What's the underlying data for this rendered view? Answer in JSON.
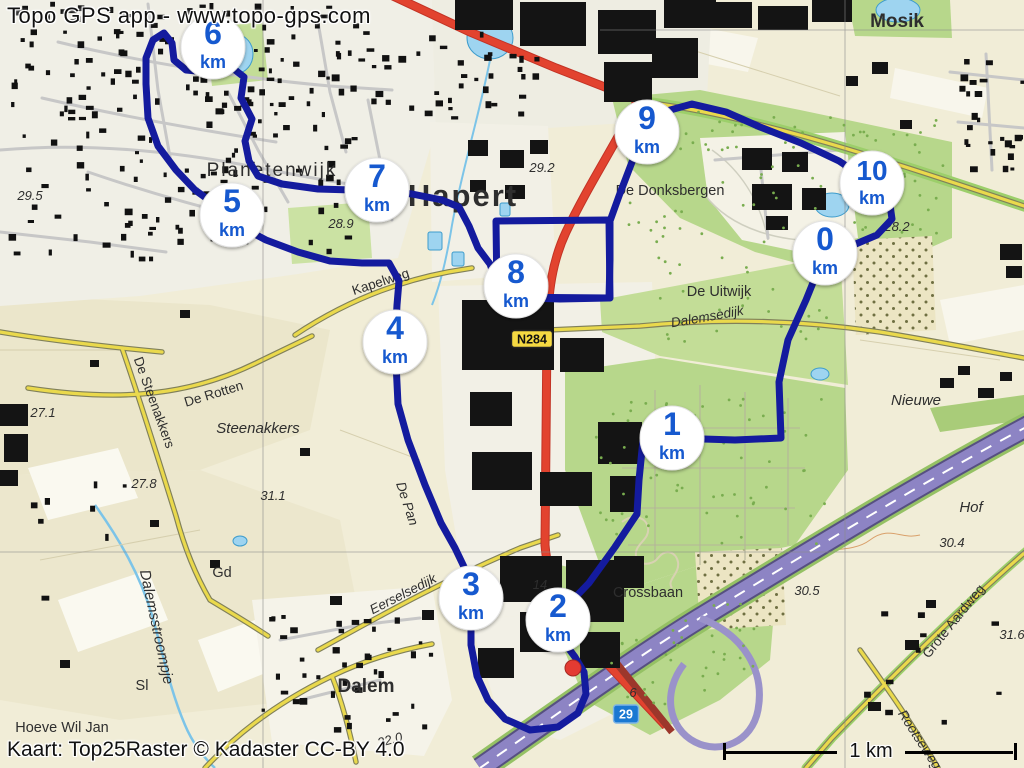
{
  "overlay": {
    "app_credit": "Topo GPS app - www.topo-gps.com",
    "attribution": "Kaart: Top25Raster © Kadaster CC-BY 4.0",
    "scale_label": "1 km"
  },
  "map": {
    "route": {
      "color": "#141b9e",
      "width": 7,
      "points": [
        [
          825,
          253
        ],
        [
          806,
          300
        ],
        [
          788,
          340
        ],
        [
          779,
          382
        ],
        [
          781,
          438
        ],
        [
          735,
          440
        ],
        [
          672,
          438
        ],
        [
          643,
          440
        ],
        [
          639,
          480
        ],
        [
          637,
          514
        ],
        [
          615,
          547
        ],
        [
          589,
          583
        ],
        [
          566,
          607
        ],
        [
          558,
          622
        ],
        [
          563,
          641
        ],
        [
          575,
          657
        ],
        [
          584,
          672
        ],
        [
          586,
          694
        ],
        [
          578,
          713
        ],
        [
          558,
          727
        ],
        [
          530,
          730
        ],
        [
          505,
          719
        ],
        [
          488,
          700
        ],
        [
          477,
          676
        ],
        [
          471,
          645
        ],
        [
          471,
          598
        ],
        [
          466,
          571
        ],
        [
          455,
          548
        ],
        [
          441,
          523
        ],
        [
          425,
          485
        ],
        [
          408,
          440
        ],
        [
          398,
          404
        ],
        [
          395,
          342
        ],
        [
          397,
          305
        ],
        [
          399,
          281
        ],
        [
          389,
          263
        ],
        [
          362,
          263
        ],
        [
          330,
          261
        ],
        [
          298,
          252
        ],
        [
          266,
          240
        ],
        [
          245,
          229
        ],
        [
          232,
          215
        ],
        [
          213,
          203
        ],
        [
          195,
          190
        ],
        [
          176,
          170
        ],
        [
          158,
          146
        ],
        [
          148,
          118
        ],
        [
          146,
          84
        ],
        [
          146,
          58
        ],
        [
          153,
          40
        ],
        [
          164,
          33
        ],
        [
          172,
          43
        ],
        [
          174,
          60
        ],
        [
          186,
          70
        ],
        [
          208,
          72
        ],
        [
          230,
          66
        ],
        [
          244,
          77
        ],
        [
          241,
          98
        ],
        [
          252,
          119
        ],
        [
          245,
          141
        ],
        [
          249,
          161
        ],
        [
          258,
          176
        ],
        [
          282,
          184
        ],
        [
          318,
          189
        ],
        [
          352,
          190
        ],
        [
          377,
          190
        ],
        [
          412,
          194
        ],
        [
          442,
          200
        ],
        [
          459,
          207
        ],
        [
          469,
          226
        ],
        [
          478,
          248
        ],
        [
          490,
          264
        ],
        [
          496,
          281
        ],
        [
          497,
          297
        ],
        [
          560,
          299
        ],
        [
          609,
          298
        ],
        [
          610,
          260
        ],
        [
          610,
          221
        ],
        [
          619,
          196
        ],
        [
          632,
          162
        ],
        [
          647,
          132
        ],
        [
          663,
          112
        ],
        [
          692,
          104
        ],
        [
          726,
          112
        ],
        [
          760,
          127
        ],
        [
          801,
          143
        ],
        [
          839,
          161
        ],
        [
          872,
          183
        ],
        [
          889,
          198
        ],
        [
          892,
          219
        ],
        [
          877,
          235
        ],
        [
          851,
          246
        ],
        [
          825,
          253
        ]
      ],
      "block_loop": [
        [
          496,
          221
        ],
        [
          609,
          220
        ],
        [
          610,
          298
        ],
        [
          497,
          297
        ]
      ],
      "waypoint": {
        "x": 573,
        "y": 668,
        "color": "#e33b32"
      }
    },
    "markers": {
      "unit": "km",
      "text_color": "#1659cf",
      "items": [
        {
          "label": "0",
          "x": 825,
          "y": 253
        },
        {
          "label": "1",
          "x": 672,
          "y": 438
        },
        {
          "label": "2",
          "x": 558,
          "y": 620
        },
        {
          "label": "3",
          "x": 471,
          "y": 598
        },
        {
          "label": "4",
          "x": 395,
          "y": 342
        },
        {
          "label": "5",
          "x": 232,
          "y": 215
        },
        {
          "label": "6",
          "x": 213,
          "y": 47
        },
        {
          "label": "7",
          "x": 377,
          "y": 190
        },
        {
          "label": "8",
          "x": 516,
          "y": 286
        },
        {
          "label": "9",
          "x": 647,
          "y": 132
        },
        {
          "label": "10",
          "x": 872,
          "y": 183
        }
      ]
    },
    "road_shields": [
      {
        "text": "N284",
        "x": 532,
        "y": 339,
        "style": "provincial",
        "bg": "#f5d942",
        "fg": "#111111"
      },
      {
        "text": "29",
        "x": 626,
        "y": 714,
        "style": "motorway",
        "bg": "#1a78d2",
        "fg": "#ffffff"
      }
    ],
    "place_labels": [
      {
        "text": "Hapert",
        "x": 463,
        "y": 206,
        "cls": "town1"
      },
      {
        "text": "Planetenwijk",
        "x": 272,
        "y": 176,
        "cls": "town2"
      },
      {
        "text": "Mosik",
        "x": 897,
        "y": 27,
        "cls": "town3"
      },
      {
        "text": "Dalem",
        "x": 366,
        "y": 692,
        "cls": "town3"
      },
      {
        "text": "De Donksbergen",
        "x": 670,
        "y": 195,
        "cls": "area"
      },
      {
        "text": "De Uitwijk",
        "x": 719,
        "y": 296,
        "cls": "area"
      },
      {
        "text": "Steenakkers",
        "x": 258,
        "y": 433,
        "cls": "area-i"
      },
      {
        "text": "Nieuwe",
        "x": 916,
        "y": 405,
        "cls": "area-i"
      },
      {
        "text": "Hof",
        "x": 971,
        "y": 512,
        "cls": "area-i"
      },
      {
        "text": "Crossbaan",
        "x": 648,
        "y": 597,
        "cls": "area"
      },
      {
        "text": "Hoeve Wil Jan",
        "x": 62,
        "y": 732,
        "cls": "area"
      },
      {
        "text": "Gd",
        "x": 222,
        "y": 577,
        "cls": "area"
      },
      {
        "text": "Sl",
        "x": 142,
        "y": 690,
        "cls": "area"
      },
      {
        "text": "De Rotten",
        "x": 215,
        "y": 398,
        "rot": -17,
        "cls": "road"
      },
      {
        "text": "De Steenakkers",
        "x": 150,
        "y": 404,
        "rot": 70,
        "cls": "road"
      },
      {
        "text": "Kapelweg",
        "x": 382,
        "y": 286,
        "rot": -18,
        "cls": "road"
      },
      {
        "text": "Dalemsedijk",
        "x": 708,
        "y": 321,
        "rot": -10,
        "cls": "road-i"
      },
      {
        "text": "Eerselsedijk",
        "x": 405,
        "y": 598,
        "rot": -27,
        "cls": "road-i"
      },
      {
        "text": "De Pan",
        "x": 403,
        "y": 505,
        "rot": 72,
        "cls": "road-i"
      },
      {
        "text": "Grote Aardweg",
        "x": 957,
        "y": 624,
        "rot": -51,
        "cls": "road"
      },
      {
        "text": "Rootseweg",
        "x": 916,
        "y": 742,
        "rot": 57,
        "cls": "road-i"
      },
      {
        "text": "Dalemsstroompje",
        "x": 152,
        "y": 628,
        "rot": 78,
        "cls": "water"
      },
      {
        "text": "29.5",
        "x": 30,
        "y": 200,
        "cls": "spot"
      },
      {
        "text": "28.9",
        "x": 341,
        "y": 228,
        "cls": "spot"
      },
      {
        "text": "29.2",
        "x": 542,
        "y": 172,
        "cls": "spot"
      },
      {
        "text": "28.2",
        "x": 897,
        "y": 231,
        "cls": "spot"
      },
      {
        "text": "27.1",
        "x": 43,
        "y": 417,
        "cls": "spot"
      },
      {
        "text": "27.8",
        "x": 144,
        "y": 488,
        "cls": "spot"
      },
      {
        "text": "31.1",
        "x": 273,
        "y": 500,
        "cls": "spot"
      },
      {
        "text": "30.4",
        "x": 952,
        "y": 547,
        "cls": "spot"
      },
      {
        "text": "30.5",
        "x": 807,
        "y": 595,
        "cls": "spot"
      },
      {
        "text": "31.6",
        "x": 1012,
        "y": 639,
        "cls": "spot"
      },
      {
        "text": "22.0",
        "x": 391,
        "y": 744,
        "rot": -15,
        "cls": "spot"
      },
      {
        "text": "14",
        "x": 540,
        "y": 589,
        "cls": "spot"
      },
      {
        "text": "6",
        "x": 633,
        "y": 697,
        "cls": "spot"
      }
    ]
  }
}
